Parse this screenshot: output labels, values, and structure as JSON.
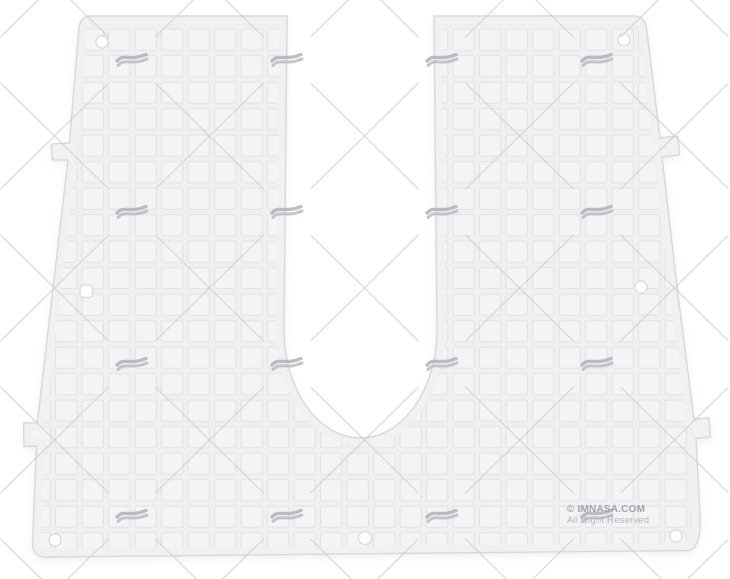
{
  "photo": {
    "copyright": "© IMNASA.COM",
    "rights": "All Right Reserved",
    "brand": "IMNASA",
    "watermark_logo": "imnasa-wave-logo",
    "subject": "White plastic outboard transom pad with waffle grid texture, U-shaped cutout, side tabs and mounting holes"
  },
  "colors": {
    "background": "#ffffff",
    "pad_fill": "#f0f0f2",
    "pad_square": "#f3f4f5",
    "grid_line": "#e1e2e4",
    "pad_outline": "#d7d8da",
    "watermark_line": "#c9cbce",
    "watermark_logo": "#aeb2b6",
    "copyright_text": "#9fa2a6"
  },
  "holes": {
    "count": 7
  }
}
